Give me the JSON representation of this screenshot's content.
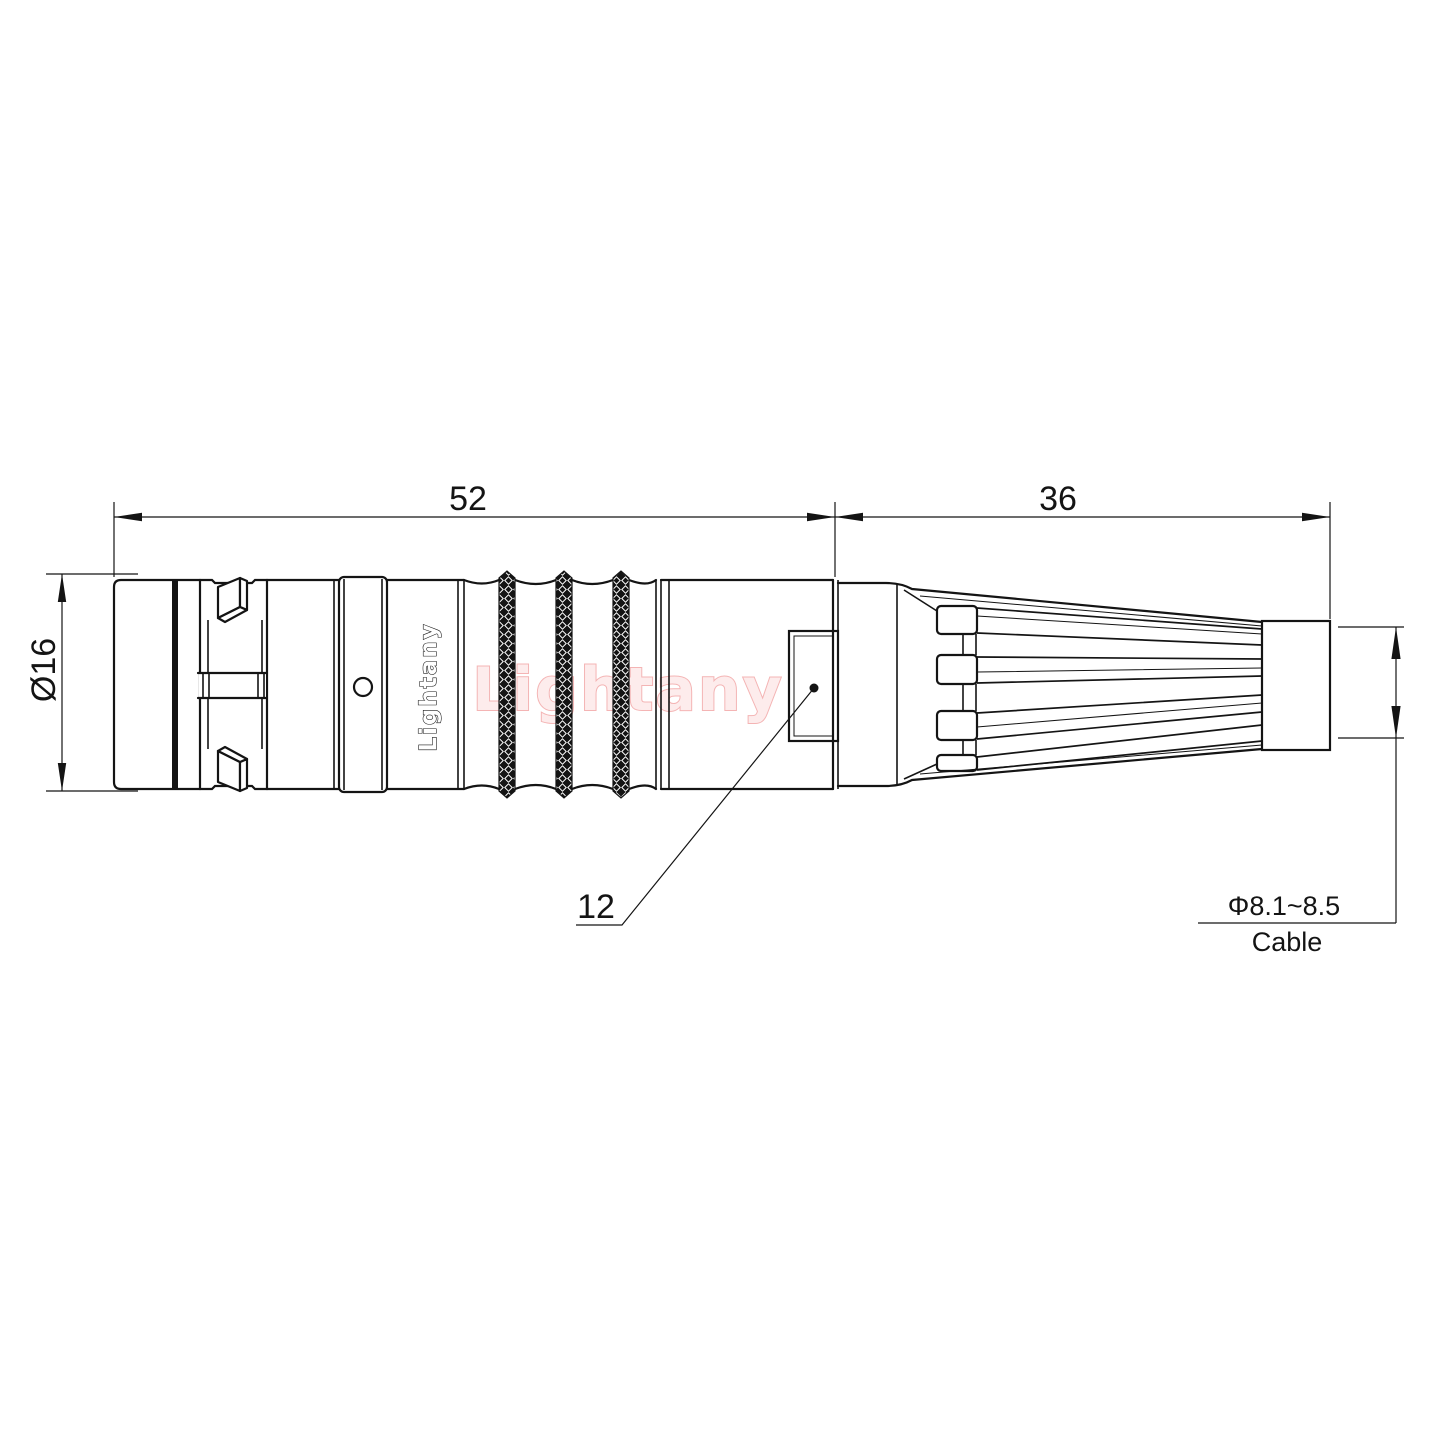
{
  "drawing": {
    "type": "connector-technical-drawing",
    "dimensions": {
      "length_front": "52",
      "length_boot": "36",
      "diameter_body": "Ø16",
      "nut_size": "12",
      "cable_diameter": "Φ8.1~8.5",
      "cable_label": "Cable"
    },
    "branding": {
      "engraving": "Lightany",
      "watermark": "Lightany"
    },
    "colors": {
      "line": "#141414",
      "watermark_stroke": "#f4b4b4",
      "watermark_fill": "#fdecec",
      "background": "#ffffff"
    }
  }
}
